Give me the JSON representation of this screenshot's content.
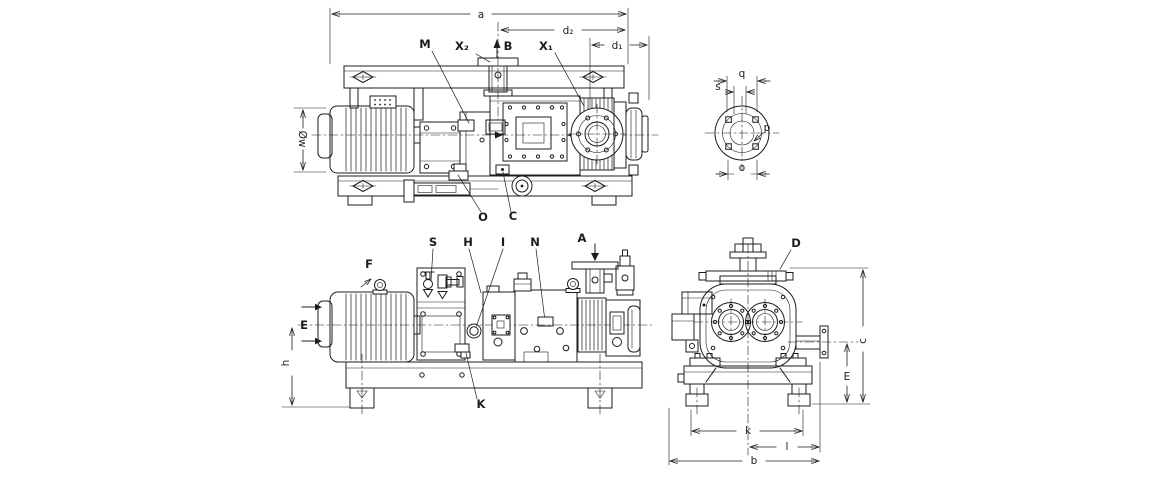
{
  "colors": {
    "line": "#1c1c1c",
    "background": "#ffffff"
  },
  "views": {
    "top_side_view": {
      "dims": {
        "a": "a",
        "d2": "d₂",
        "d1": "d₁",
        "motor_diameter": "Øw"
      },
      "callouts": {
        "m": "M",
        "x2": "X₂",
        "b": "B",
        "x1": "X₁",
        "o": "O",
        "c": "C"
      }
    },
    "flange_detail": {
      "dims": {
        "q": "q",
        "s": "s",
        "o": "o"
      },
      "callouts": {
        "p": "p"
      }
    },
    "front_side_view": {
      "dims": {
        "h": "h"
      },
      "callouts": {
        "s": "S",
        "h": "H",
        "i": "I",
        "n": "N",
        "a": "A",
        "f": "F",
        "e": "E",
        "k": "K"
      }
    },
    "end_view": {
      "dims": {
        "c": "c",
        "e": "E",
        "k": "k",
        "l": "l",
        "b": "b"
      },
      "callouts": {
        "d": "D"
      }
    }
  }
}
